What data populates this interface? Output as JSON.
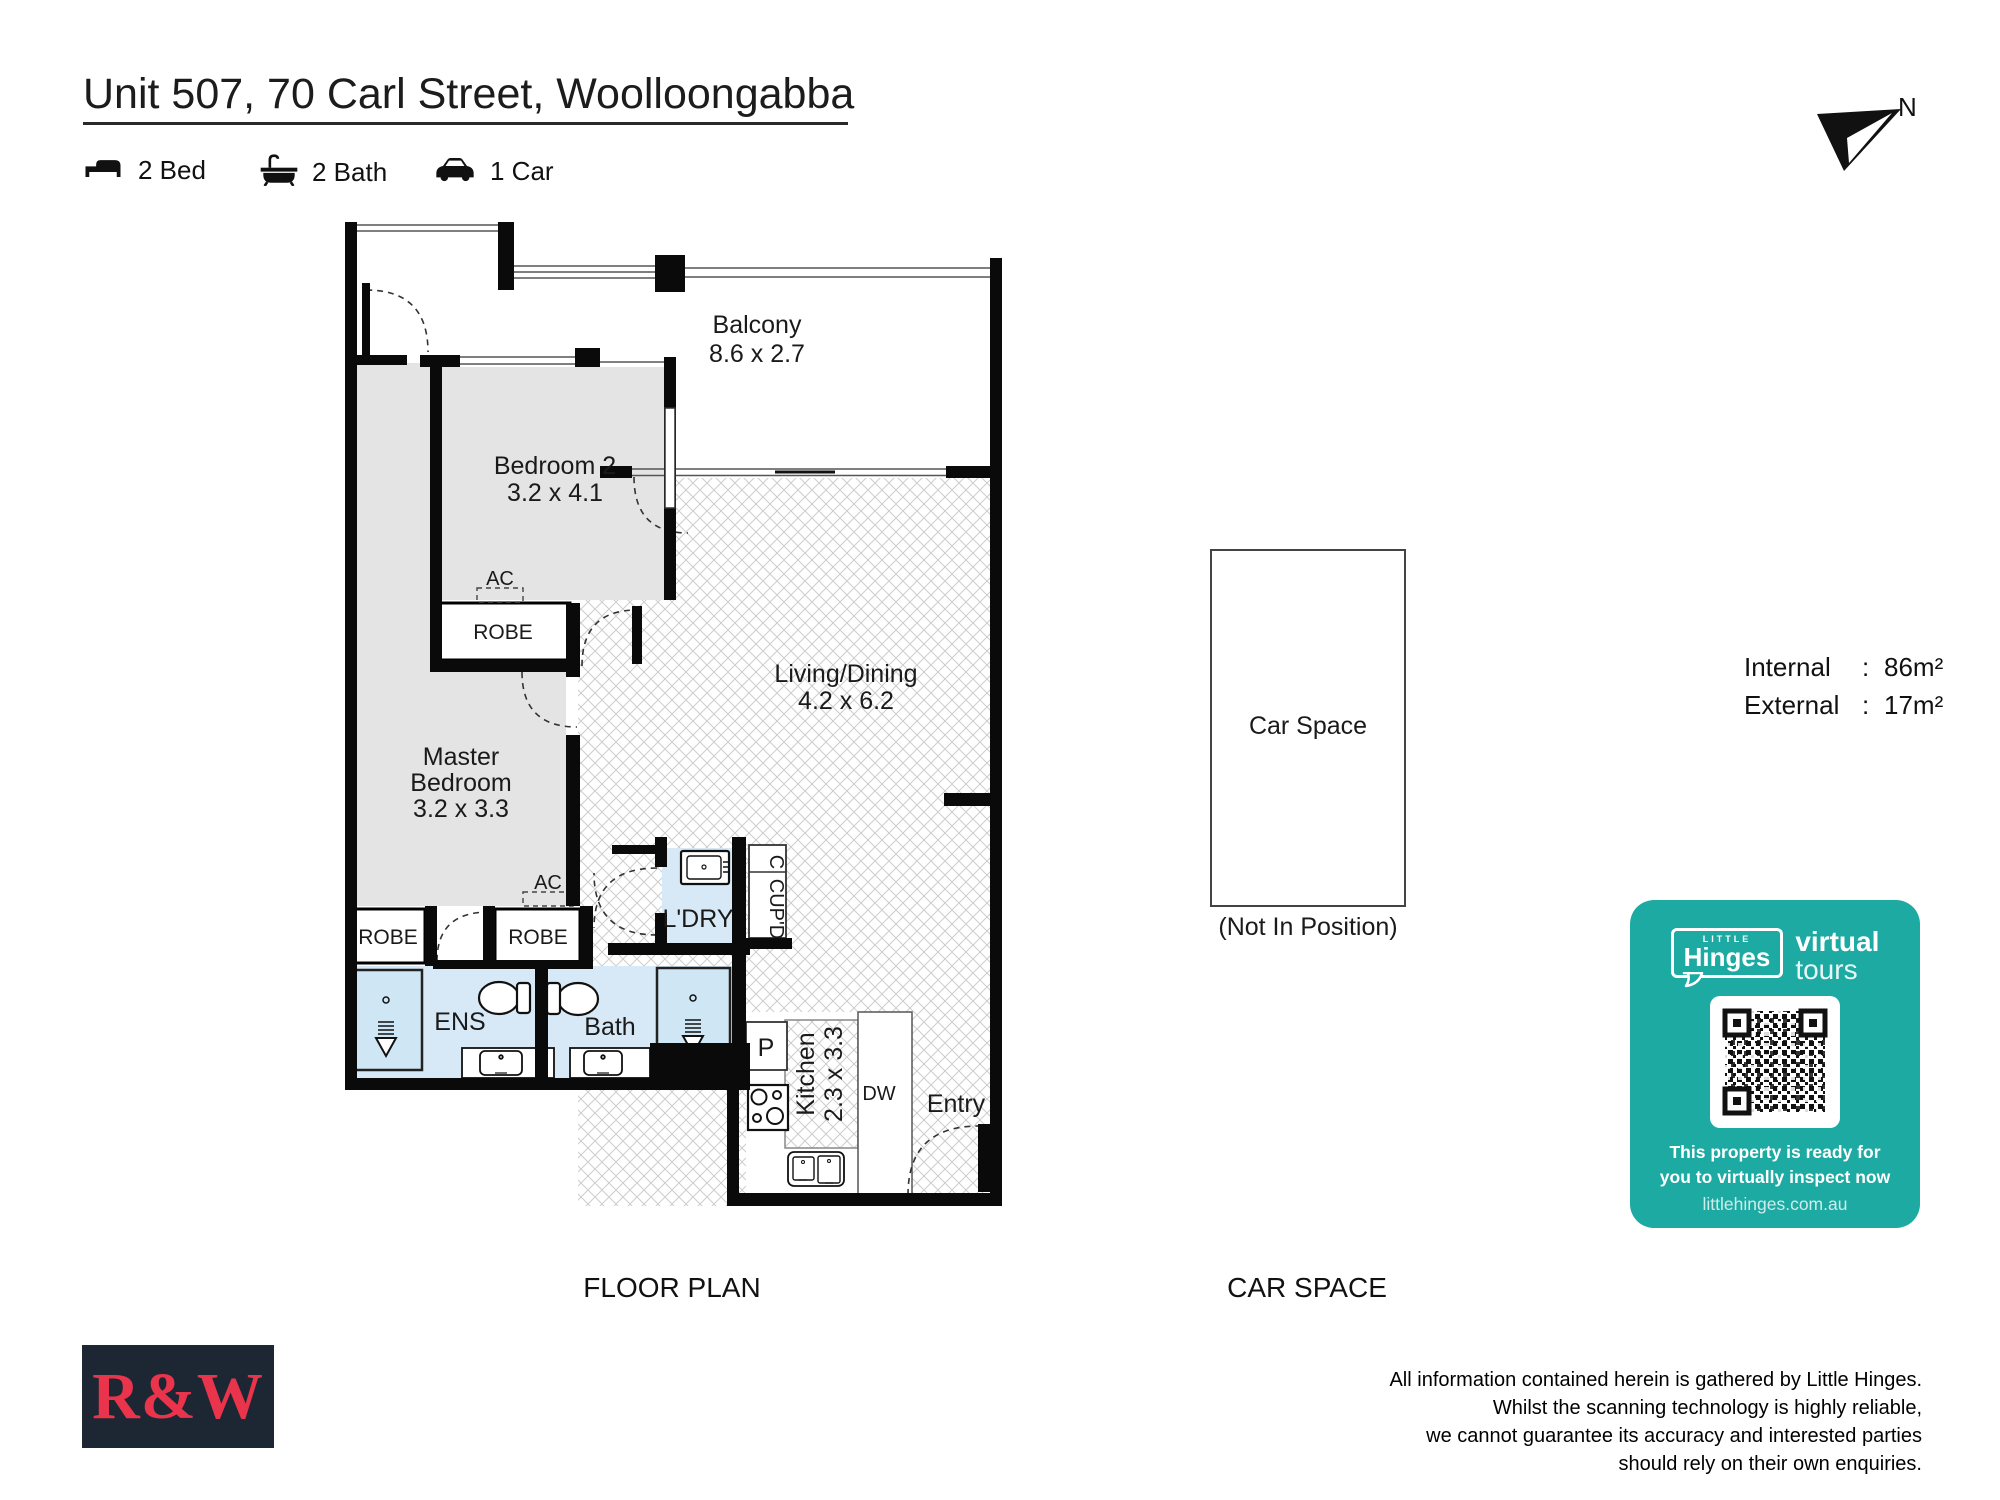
{
  "header": {
    "title": "Unit 507, 70 Carl Street, Woolloongabba",
    "features": [
      {
        "icon": "bed-icon",
        "label": "2 Bed"
      },
      {
        "icon": "bath-icon",
        "label": "2 Bath"
      },
      {
        "icon": "car-icon",
        "label": "1 Car"
      }
    ]
  },
  "compass": {
    "label": "N"
  },
  "plan": {
    "section_label": "FLOOR PLAN",
    "rooms": {
      "balcony": {
        "name": "Balcony",
        "dims": "8.6 x 2.7"
      },
      "bedroom2": {
        "name": "Bedroom 2",
        "dims": "3.2 x 4.1"
      },
      "living": {
        "name": "Living/Dining",
        "dims": "4.2 x 6.2"
      },
      "master": {
        "name_line1": "Master",
        "name_line2": "Bedroom",
        "dims": "3.2 x 3.3"
      },
      "kitchen": {
        "name": "Kitchen",
        "dims": "2.3 x 3.3"
      }
    },
    "labels": {
      "robe": "ROBE",
      "ac": "AC",
      "ldry": "L'DRY",
      "cupd": "CUP'D",
      "c": "C",
      "ens": "ENS",
      "bath": "Bath",
      "p": "P",
      "dw": "DW",
      "entry": "Entry"
    }
  },
  "car_space": {
    "section_label": "CAR SPACE",
    "label": "Car Space",
    "note": "(Not In Position)"
  },
  "areas": {
    "internal_label": "Internal",
    "internal_value": "86m²",
    "external_label": "External",
    "external_value": "17m²",
    "colon": ":"
  },
  "hinges_card": {
    "brand_small": "LITTLE",
    "brand": "Hinges",
    "virtual": "virtual",
    "tours": "tours",
    "line1": "This property is ready for",
    "line2": "you to virtually inspect now",
    "url": "littlehinges.com.au",
    "teal": "#1caaa2"
  },
  "branding": {
    "rw_logo": "R&W"
  },
  "disclaimer": {
    "lines": [
      "All information contained herein is gathered by Little Hinges.",
      "Whilst the scanning technology is highly reliable,",
      "we cannot guarantee its accuracy and interested parties",
      "should rely on their own enquiries."
    ]
  }
}
